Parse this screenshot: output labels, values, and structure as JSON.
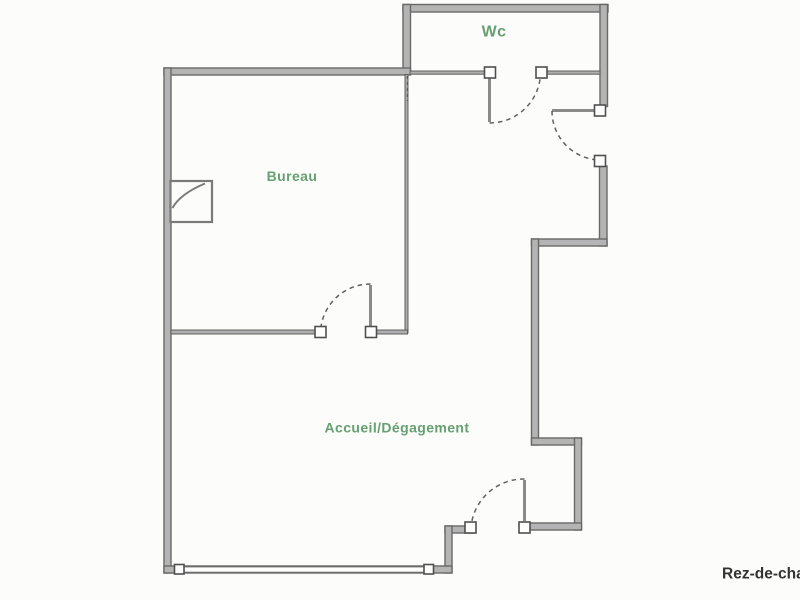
{
  "labels": {
    "wc": "Wc",
    "bureau": "Bureau",
    "accueil": "Accueil/Dégagement",
    "floor": "Rez-de-chau"
  },
  "colors": {
    "room_label": "#66a072",
    "floor_label": "#333333",
    "wall_fill": "#b4b4b4",
    "wall_edge": "#696969",
    "background": "#fcfcfa"
  }
}
